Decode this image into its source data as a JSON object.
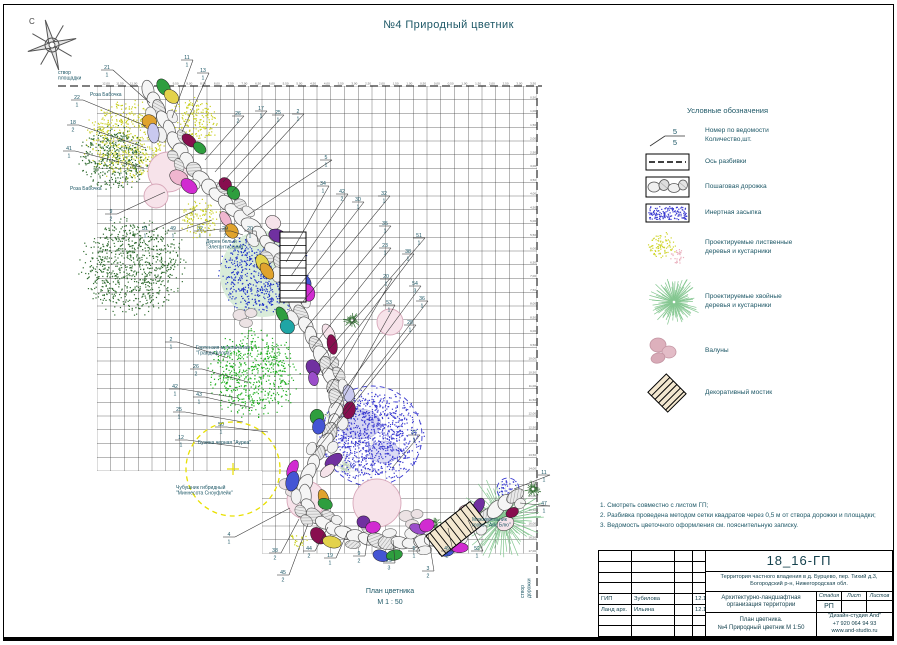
{
  "title": "№4 Природный цветник",
  "compass": {
    "north_label": "С"
  },
  "plan": {
    "ink": "#1d5766",
    "caption_line1": "План цветника",
    "caption_line2": "М 1 : 50",
    "axis_label_top": "створ\nплощадки",
    "axis_label_right": "створ дорожки",
    "grid": {
      "x": 97,
      "y": 86,
      "cols": 32,
      "rows": 34,
      "cell": 13.75
    },
    "tick_start": "12,00",
    "tick_step": "0,50",
    "palette": [
      "#d12bd1",
      "#7030a0",
      "#2e9e3e",
      "#e3d24b",
      "#4455d4",
      "#f0b6cf",
      "#9b4dca",
      "#1fa5a5",
      "#e0a32e",
      "#7030a0",
      "#d12bd1",
      "#c9c9ef",
      "#2e9e3e",
      "#f6e3ea",
      "#4455d4",
      "#880e4f"
    ],
    "path": [
      [
        148,
        90
      ],
      [
        158,
        108
      ],
      [
        167,
        126
      ],
      [
        176,
        144
      ],
      [
        187,
        161
      ],
      [
        199,
        176
      ],
      [
        212,
        190
      ],
      [
        226,
        203
      ],
      [
        240,
        216
      ],
      [
        254,
        228
      ],
      [
        266,
        241
      ],
      [
        277,
        255
      ],
      [
        285,
        270
      ],
      [
        291,
        286
      ],
      [
        296,
        302
      ],
      [
        303,
        319
      ],
      [
        311,
        336
      ],
      [
        320,
        353
      ],
      [
        328,
        370
      ],
      [
        334,
        387
      ],
      [
        337,
        404
      ],
      [
        334,
        422
      ],
      [
        327,
        439
      ],
      [
        318,
        455
      ],
      [
        309,
        471
      ],
      [
        304,
        487
      ],
      [
        306,
        503
      ],
      [
        315,
        517
      ],
      [
        330,
        527
      ],
      [
        348,
        534
      ],
      [
        367,
        539
      ],
      [
        387,
        542
      ],
      [
        407,
        543
      ],
      [
        427,
        541
      ],
      [
        446,
        536
      ],
      [
        464,
        529
      ],
      [
        480,
        520
      ],
      [
        495,
        510
      ],
      [
        509,
        500
      ],
      [
        523,
        491
      ]
    ],
    "features": [
      {
        "type": "stipple",
        "cx": 128,
        "cy": 140,
        "r": 42,
        "color": "#c9cf1f"
      },
      {
        "type": "stipple",
        "cx": 193,
        "cy": 120,
        "r": 24,
        "color": "#c9cf1f"
      },
      {
        "type": "stipple",
        "cx": 200,
        "cy": 218,
        "r": 20,
        "color": "#c9cf1f"
      },
      {
        "type": "stipple",
        "cx": 298,
        "cy": 540,
        "r": 9,
        "color": "#c9cf1f"
      },
      {
        "type": "stipple",
        "cx": 112,
        "cy": 158,
        "r": 34,
        "color": "#2f6b2f"
      },
      {
        "type": "stipple",
        "cx": 133,
        "cy": 265,
        "r": 50,
        "color": "#2f6b2f"
      },
      {
        "type": "stipple-on",
        "cx": 263,
        "cy": 274,
        "r": 43,
        "color": "#2437c8",
        "base": "#d9ecd9"
      },
      {
        "type": "stipple",
        "cx": 252,
        "cy": 374,
        "r": 44,
        "color": "#1fae1f"
      },
      {
        "type": "dashed-circle",
        "cx": 233,
        "cy": 469,
        "r": 47,
        "color": "#e8e000"
      },
      {
        "type": "spiky",
        "cx": 503,
        "cy": 519,
        "r": 43,
        "color": "#85c791"
      },
      {
        "type": "spiky",
        "cx": 352,
        "cy": 320,
        "r": 9,
        "color": "#2f6b2f"
      },
      {
        "type": "spiky",
        "cx": 333,
        "cy": 417,
        "r": 9,
        "color": "#2f6b2f"
      },
      {
        "type": "spiky",
        "cx": 345,
        "cy": 467,
        "r": 8,
        "color": "#2f6b2f"
      },
      {
        "type": "spiky",
        "cx": 533,
        "cy": 489,
        "r": 9,
        "color": "#2f6b2f"
      },
      {
        "type": "spiky",
        "cx": 434,
        "cy": 524,
        "r": 8,
        "color": "#2f6b2f"
      },
      {
        "type": "infill",
        "cx": 372,
        "cy": 436,
        "r": 50,
        "color": "#3a3ad0"
      },
      {
        "type": "infill",
        "cx": 508,
        "cy": 489,
        "r": 11,
        "color": "#3a3ad0"
      },
      {
        "type": "pink",
        "cx": 168,
        "cy": 172,
        "r": 20
      },
      {
        "type": "pink",
        "cx": 156,
        "cy": 196,
        "r": 12
      },
      {
        "type": "pink",
        "cx": 306,
        "cy": 500,
        "r": 19
      },
      {
        "type": "pink",
        "cx": 377,
        "cy": 503,
        "r": 24
      },
      {
        "type": "pink",
        "cx": 390,
        "cy": 322,
        "r": 13
      },
      {
        "type": "boulders",
        "cx": 246,
        "cy": 318
      },
      {
        "type": "boulders",
        "cx": 292,
        "cy": 487
      },
      {
        "type": "boulders",
        "cx": 412,
        "cy": 519
      },
      {
        "type": "bridge-ladder",
        "x": 280,
        "y": 232,
        "w": 26,
        "h": 70
      },
      {
        "type": "bridge",
        "cx": 456,
        "cy": 529,
        "w": 56,
        "h": 26,
        "rot": -38
      }
    ],
    "labels": [
      {
        "n": "21",
        "q": "1",
        "x": 106,
        "y": 70,
        "tx": 150,
        "ty": 103
      },
      {
        "n": "11",
        "q": "1",
        "x": 186,
        "y": 60,
        "tx": 172,
        "ty": 118
      },
      {
        "n": "13",
        "q": "1",
        "x": 202,
        "y": 73,
        "tx": 182,
        "ty": 132
      },
      {
        "n": "22",
        "q": "1",
        "x": 76,
        "y": 100,
        "tx": 146,
        "ty": 126
      },
      {
        "n": "18",
        "q": "2",
        "x": 72,
        "y": 125,
        "tx": 146,
        "ty": 148
      },
      {
        "n": "41",
        "q": "1",
        "x": 68,
        "y": 151,
        "tx": 144,
        "ty": 168
      },
      {
        "n": "9",
        "q": "2",
        "x": 110,
        "y": 214,
        "tx": 165,
        "ty": 192
      },
      {
        "n": "31",
        "q": "1",
        "x": 144,
        "y": 231,
        "tx": 196,
        "ty": 210
      },
      {
        "n": "49",
        "q": "1",
        "x": 172,
        "y": 231,
        "tx": 212,
        "ty": 220
      },
      {
        "n": "32",
        "q": "1",
        "x": 199,
        "y": 231,
        "tx": 228,
        "ty": 228
      },
      {
        "n": "29",
        "q": "2",
        "x": 224,
        "y": 231,
        "tx": 243,
        "ty": 235
      },
      {
        "n": "20",
        "q": "1",
        "x": 249,
        "y": 231,
        "tx": 258,
        "ty": 242
      },
      {
        "n": "26",
        "q": "2",
        "x": 237,
        "y": 116,
        "tx": 205,
        "ty": 160
      },
      {
        "n": "17",
        "q": "1",
        "x": 260,
        "y": 111,
        "tx": 215,
        "ty": 172
      },
      {
        "n": "25",
        "q": "1",
        "x": 277,
        "y": 115,
        "tx": 223,
        "ty": 182
      },
      {
        "n": "2",
        "q": "1",
        "x": 297,
        "y": 114,
        "tx": 232,
        "ty": 192
      },
      {
        "n": "5",
        "q": "1",
        "x": 325,
        "y": 160,
        "tx": 248,
        "ty": 215
      },
      {
        "n": "34",
        "q": "1",
        "x": 322,
        "y": 186,
        "tx": 286,
        "ty": 262
      },
      {
        "n": "42",
        "q": "2",
        "x": 341,
        "y": 194,
        "tx": 291,
        "ty": 276
      },
      {
        "n": "30",
        "q": "1",
        "x": 357,
        "y": 202,
        "tx": 296,
        "ty": 290
      },
      {
        "n": "32",
        "q": "1",
        "x": 383,
        "y": 196,
        "tx": 301,
        "ty": 304
      },
      {
        "n": "35",
        "q": "1",
        "x": 384,
        "y": 226,
        "tx": 306,
        "ty": 328
      },
      {
        "n": "23",
        "q": "1",
        "x": 384,
        "y": 248,
        "tx": 312,
        "ty": 348
      },
      {
        "n": "51",
        "q": "1",
        "x": 418,
        "y": 238,
        "tx": 318,
        "ty": 362
      },
      {
        "n": "38",
        "q": "1",
        "x": 407,
        "y": 254,
        "tx": 322,
        "ty": 376
      },
      {
        "n": "20",
        "q": "1",
        "x": 385,
        "y": 279,
        "tx": 327,
        "ty": 392
      },
      {
        "n": "54",
        "q": "3",
        "x": 414,
        "y": 286,
        "tx": 331,
        "ty": 408
      },
      {
        "n": "53",
        "q": "1",
        "x": 388,
        "y": 305,
        "tx": 329,
        "ty": 424
      },
      {
        "n": "36",
        "q": "1",
        "x": 421,
        "y": 301,
        "tx": 323,
        "ty": 438
      },
      {
        "n": "28",
        "q": "1",
        "x": 409,
        "y": 325,
        "tx": 315,
        "ty": 452
      },
      {
        "n": "2",
        "q": "1",
        "x": 170,
        "y": 342,
        "tx": 228,
        "ty": 358
      },
      {
        "n": "26",
        "q": "2",
        "x": 195,
        "y": 369,
        "tx": 248,
        "ty": 382
      },
      {
        "n": "42",
        "q": "1",
        "x": 174,
        "y": 389,
        "tx": 238,
        "ty": 398
      },
      {
        "n": "43",
        "q": "1",
        "x": 198,
        "y": 397,
        "tx": 253,
        "ty": 408
      },
      {
        "n": "25",
        "q": "1",
        "x": 178,
        "y": 412,
        "tx": 243,
        "ty": 422
      },
      {
        "n": "50",
        "q": "1",
        "x": 220,
        "y": 427,
        "tx": 268,
        "ty": 432
      },
      {
        "n": "12",
        "q": "1",
        "x": 180,
        "y": 440,
        "tx": 248,
        "ty": 448
      },
      {
        "n": "37",
        "q": "1",
        "x": 413,
        "y": 435,
        "tx": 392,
        "ty": 468
      },
      {
        "n": "11",
        "q": "1",
        "x": 543,
        "y": 475,
        "tx": 514,
        "ty": 489
      },
      {
        "n": "47",
        "q": "1",
        "x": 543,
        "y": 506,
        "tx": 520,
        "ty": 503
      },
      {
        "n": "4",
        "q": "1",
        "x": 228,
        "y": 537,
        "tx": 290,
        "ty": 508
      },
      {
        "n": "38",
        "q": "2",
        "x": 274,
        "y": 553,
        "tx": 299,
        "ty": 519
      },
      {
        "n": "45",
        "q": "2",
        "x": 282,
        "y": 575,
        "tx": 308,
        "ty": 524
      },
      {
        "n": "44",
        "q": "2",
        "x": 308,
        "y": 551,
        "tx": 328,
        "ty": 527
      },
      {
        "n": "19",
        "q": "1",
        "x": 329,
        "y": 558,
        "tx": 348,
        "ty": 531
      },
      {
        "n": "9",
        "q": "2",
        "x": 358,
        "y": 556,
        "tx": 368,
        "ty": 536
      },
      {
        "n": "29",
        "q": "3",
        "x": 388,
        "y": 563,
        "tx": 393,
        "ty": 540
      },
      {
        "n": "5",
        "q": "1",
        "x": 413,
        "y": 551,
        "tx": 413,
        "ty": 538
      },
      {
        "n": "3",
        "q": "2",
        "x": 427,
        "y": 571,
        "tx": 428,
        "ty": 534
      },
      {
        "n": "49",
        "q": "2",
        "x": 446,
        "y": 551,
        "tx": 448,
        "ty": 528
      },
      {
        "n": "52",
        "q": "1",
        "x": 476,
        "y": 551,
        "tx": 468,
        "ty": 520
      }
    ],
    "annotations": [
      {
        "text": "Роза Бабочка",
        "x": 90,
        "y": 96
      },
      {
        "text": "Роза Бабочка",
        "x": 70,
        "y": 190
      },
      {
        "text": "Дерен белый\n\"Элегантиссима\"",
        "x": 206,
        "y": 243
      },
      {
        "text": "Гортензия метельчатая\n\"Грандифлора\"",
        "x": 196,
        "y": 349
      },
      {
        "text": "Бузина черная \"Ауреа\"",
        "x": 198,
        "y": 444
      },
      {
        "text": "Чубушник гибридный\n\"Миннесота Сноуфлейк\"",
        "x": 176,
        "y": 489
      },
      {
        "text": "Можжевельник\nгориз. \"Айс Блю\"",
        "x": 472,
        "y": 521
      },
      {
        "text": "створ\nплощадки",
        "x": 58,
        "y": 74
      }
    ]
  },
  "legend": {
    "title": "Условные обозначения",
    "sample_number": "5",
    "items": [
      {
        "icon": "number-leader",
        "label": "Номер по ведомости\nКоличество,шт."
      },
      {
        "icon": "axis-line",
        "label": "Ось разбивки"
      },
      {
        "icon": "stepping-path",
        "label": "Пошаговая дорожка"
      },
      {
        "icon": "inert-infill",
        "label": "Инертная засыпка"
      },
      {
        "icon": "deciduous-plants",
        "label": "Проектируемые лиственные\nдеревья и кустарники"
      },
      {
        "icon": "conifer-plants",
        "label": "Проектируемые хвойные\nдеревья и кустарники"
      },
      {
        "icon": "boulders",
        "label": "Валуны"
      },
      {
        "icon": "decorative-bridge",
        "label": "Декоративный мостик"
      }
    ]
  },
  "notes": [
    "1. Смотреть совместно с листом ГП;",
    "2. Разбивка проведена методом сетки квадратов через 0,5 м от створа дорожки  и площадки;",
    "3. Ведомость цветочного оформления см. пояснительную записку."
  ],
  "titleblock": {
    "code": "18_16-ГП",
    "address": "Территория частного владения в д. Бурцево, пер. Тихий д.3,\nБогородский р-н, Нижегородская обл.",
    "project": "Архитектурно-ландшафтная\nорганизация территории",
    "stage_header": [
      "Стадия",
      "Лист",
      "Листов"
    ],
    "stage": "РП",
    "sheet_title": "План цветника.\n№4 Природный цветник М 1:50",
    "studio": "\"Дизайн-студия And\"\n+7 920 064 94 93\nwww.and-studio.ru",
    "rows": [
      {
        "role": "ГИП",
        "name": "Зубилова",
        "date": "12.16"
      },
      {
        "role": "Ланд арх.",
        "name": "Ильина",
        "date": "12.16"
      }
    ]
  }
}
